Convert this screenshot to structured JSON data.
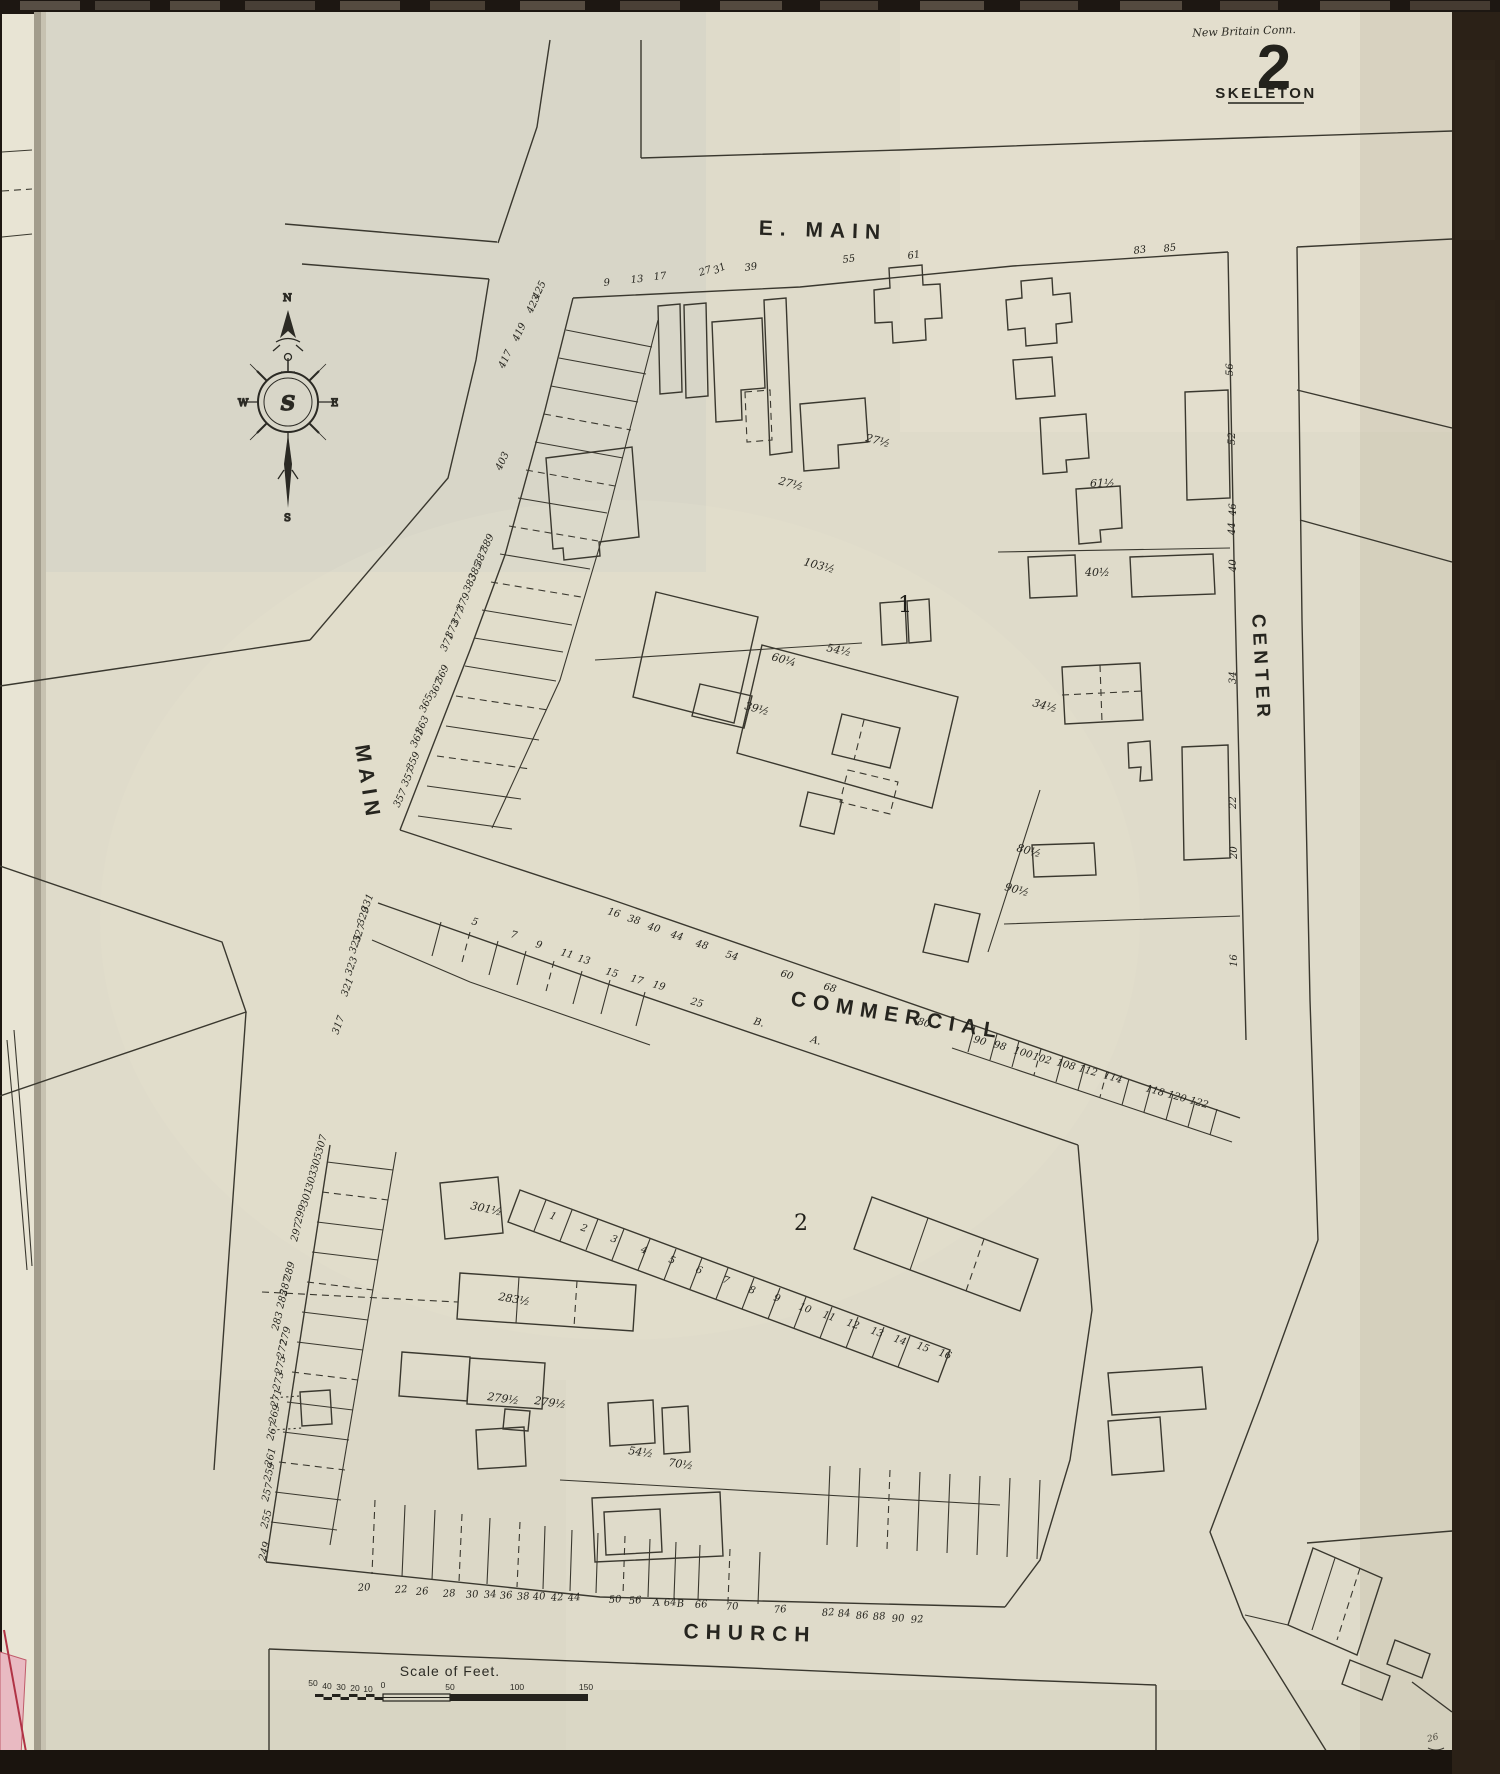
{
  "header": {
    "city_note": "New Britain Conn.",
    "sheet_number": "2",
    "map_type": "SKELETON"
  },
  "compass": {
    "north": "N",
    "south": "S",
    "east": "E",
    "west": "W",
    "monogram": "S"
  },
  "streets": {
    "e_main": "E. MAIN",
    "main": "MAIN",
    "center": "CENTER",
    "commercial": "COMMERCIAL",
    "church": "CHURCH"
  },
  "blocks": {
    "block1": "1",
    "block2": "2"
  },
  "scale_bar": {
    "title": "Scale of Feet.",
    "ticks": [
      {
        "t": "50",
        "x": 313,
        "y": 1686
      },
      {
        "t": "40",
        "x": 327,
        "y": 1689
      },
      {
        "t": "30",
        "x": 341,
        "y": 1690
      },
      {
        "t": "20",
        "x": 355,
        "y": 1691
      },
      {
        "t": "10",
        "x": 368,
        "y": 1692
      },
      {
        "t": "0",
        "x": 383,
        "y": 1688
      },
      {
        "t": "50",
        "x": 450,
        "y": 1690
      },
      {
        "t": "100",
        "x": 517,
        "y": 1690
      },
      {
        "t": "150",
        "x": 586,
        "y": 1690
      }
    ]
  },
  "page_ref": "26",
  "colors": {
    "paper": "#dfdbca",
    "ink": "#3a382f",
    "label_ink": "#26251f",
    "adjacent_sheet_pink": "#e9bac2",
    "binding_dark": "#1d1712"
  },
  "labels": [
    {
      "t": "9",
      "x": 604,
      "y": 286,
      "r": -6
    },
    {
      "t": "13",
      "x": 631,
      "y": 283,
      "r": -6
    },
    {
      "t": "17",
      "x": 654,
      "y": 280,
      "r": -6
    },
    {
      "t": "27",
      "x": 700,
      "y": 276,
      "r": -18
    },
    {
      "t": "31",
      "x": 715,
      "y": 274,
      "r": -25
    },
    {
      "t": "39",
      "x": 745,
      "y": 271,
      "r": -8
    },
    {
      "t": "55",
      "x": 843,
      "y": 263,
      "r": -8
    },
    {
      "t": "61",
      "x": 908,
      "y": 259,
      "r": -8
    },
    {
      "t": "83",
      "x": 1134,
      "y": 254,
      "r": -8
    },
    {
      "t": "85",
      "x": 1164,
      "y": 252,
      "r": -8
    },
    {
      "t": "56",
      "x": 1233,
      "y": 376,
      "r": -90
    },
    {
      "t": "52",
      "x": 1235,
      "y": 445,
      "r": -90
    },
    {
      "t": "46",
      "x": 1236,
      "y": 516,
      "r": -90
    },
    {
      "t": "44",
      "x": 1235,
      "y": 535,
      "r": -90
    },
    {
      "t": "40",
      "x": 1236,
      "y": 572,
      "r": -90
    },
    {
      "t": "34",
      "x": 1236,
      "y": 684,
      "r": -90
    },
    {
      "t": "22",
      "x": 1236,
      "y": 809,
      "r": -90
    },
    {
      "t": "20",
      "x": 1237,
      "y": 859,
      "r": -90
    },
    {
      "t": "16",
      "x": 1237,
      "y": 967,
      "r": -90
    },
    {
      "t": "425",
      "x": 538,
      "y": 300,
      "r": -65
    },
    {
      "t": "423",
      "x": 532,
      "y": 314,
      "r": -65
    },
    {
      "t": "419",
      "x": 518,
      "y": 342,
      "r": -65
    },
    {
      "t": "417",
      "x": 504,
      "y": 369,
      "r": -65
    },
    {
      "t": "403",
      "x": 501,
      "y": 471,
      "r": -65
    },
    {
      "t": "389",
      "x": 486,
      "y": 553,
      "r": -65
    },
    {
      "t": "387",
      "x": 480,
      "y": 567,
      "r": -65
    },
    {
      "t": "385",
      "x": 474,
      "y": 581,
      "r": -65
    },
    {
      "t": "383",
      "x": 469,
      "y": 593,
      "r": -65
    },
    {
      "t": "379",
      "x": 462,
      "y": 612,
      "r": -65
    },
    {
      "t": "377",
      "x": 457,
      "y": 626,
      "r": -65
    },
    {
      "t": "373",
      "x": 451,
      "y": 639,
      "r": -65
    },
    {
      "t": "371",
      "x": 446,
      "y": 652,
      "r": -65
    },
    {
      "t": "369",
      "x": 441,
      "y": 684,
      "r": -65
    },
    {
      "t": "367",
      "x": 435,
      "y": 698,
      "r": -65
    },
    {
      "t": "365",
      "x": 425,
      "y": 713,
      "r": -65
    },
    {
      "t": "363",
      "x": 421,
      "y": 735,
      "r": -65
    },
    {
      "t": "361",
      "x": 416,
      "y": 748,
      "r": -65
    },
    {
      "t": "359",
      "x": 412,
      "y": 771,
      "r": -65
    },
    {
      "t": "357",
      "x": 407,
      "y": 787,
      "r": -65
    },
    {
      "t": "357",
      "x": 399,
      "y": 808,
      "r": -65
    },
    {
      "t": "331",
      "x": 367,
      "y": 913,
      "r": -70
    },
    {
      "t": "329",
      "x": 363,
      "y": 926,
      "r": -70
    },
    {
      "t": "327",
      "x": 359,
      "y": 943,
      "r": -70
    },
    {
      "t": "325",
      "x": 355,
      "y": 954,
      "r": -70
    },
    {
      "t": "323",
      "x": 351,
      "y": 976,
      "r": -70
    },
    {
      "t": "321",
      "x": 347,
      "y": 997,
      "r": -70
    },
    {
      "t": "317",
      "x": 338,
      "y": 1035,
      "r": -70
    },
    {
      "t": "16",
      "x": 607,
      "y": 914,
      "r": 16
    },
    {
      "t": "38",
      "x": 627,
      "y": 921,
      "r": 16
    },
    {
      "t": "40",
      "x": 647,
      "y": 929,
      "r": 16
    },
    {
      "t": "44",
      "x": 670,
      "y": 937,
      "r": 16
    },
    {
      "t": "48",
      "x": 695,
      "y": 946,
      "r": 16
    },
    {
      "t": "54",
      "x": 725,
      "y": 957,
      "r": 16
    },
    {
      "t": "60",
      "x": 780,
      "y": 976,
      "r": 16
    },
    {
      "t": "68",
      "x": 823,
      "y": 989,
      "r": 16
    },
    {
      "t": "80",
      "x": 917,
      "y": 1024,
      "r": 16
    },
    {
      "t": "90",
      "x": 973,
      "y": 1042,
      "r": 16
    },
    {
      "t": "98",
      "x": 993,
      "y": 1047,
      "r": 16
    },
    {
      "t": "100",
      "x": 1013,
      "y": 1053,
      "r": 16
    },
    {
      "t": "102",
      "x": 1032,
      "y": 1059,
      "r": 16
    },
    {
      "t": "108",
      "x": 1056,
      "y": 1065,
      "r": 16
    },
    {
      "t": "112",
      "x": 1078,
      "y": 1071,
      "r": 16
    },
    {
      "t": "114",
      "x": 1103,
      "y": 1078,
      "r": 16
    },
    {
      "t": "118",
      "x": 1145,
      "y": 1091,
      "r": 16
    },
    {
      "t": "120",
      "x": 1167,
      "y": 1097,
      "r": 16
    },
    {
      "t": "122",
      "x": 1189,
      "y": 1103,
      "r": 16
    },
    {
      "t": "5",
      "x": 471,
      "y": 924,
      "r": 16
    },
    {
      "t": "7",
      "x": 510,
      "y": 937,
      "r": 16
    },
    {
      "t": "9",
      "x": 535,
      "y": 947,
      "r": 16
    },
    {
      "t": "11",
      "x": 560,
      "y": 955,
      "r": 16
    },
    {
      "t": "13",
      "x": 577,
      "y": 961,
      "r": 16
    },
    {
      "t": "15",
      "x": 605,
      "y": 974,
      "r": 16
    },
    {
      "t": "17",
      "x": 630,
      "y": 981,
      "r": 16
    },
    {
      "t": "19",
      "x": 652,
      "y": 987,
      "r": 16
    },
    {
      "t": "25",
      "x": 690,
      "y": 1004,
      "r": 16
    },
    {
      "t": "B.",
      "x": 753,
      "y": 1024,
      "r": 16
    },
    {
      "t": "A.",
      "x": 810,
      "y": 1042,
      "r": 16
    },
    {
      "t": "307",
      "x": 322,
      "y": 1154,
      "r": -75
    },
    {
      "t": "305",
      "x": 317,
      "y": 1172,
      "r": -75
    },
    {
      "t": "303",
      "x": 312,
      "y": 1190,
      "r": -75
    },
    {
      "t": "301",
      "x": 307,
      "y": 1207,
      "r": -75
    },
    {
      "t": "299",
      "x": 301,
      "y": 1224,
      "r": -75
    },
    {
      "t": "297",
      "x": 297,
      "y": 1242,
      "r": -75
    },
    {
      "t": "289",
      "x": 290,
      "y": 1281,
      "r": -75
    },
    {
      "t": "287",
      "x": 286,
      "y": 1296,
      "r": -75
    },
    {
      "t": "285",
      "x": 283,
      "y": 1309,
      "r": -75
    },
    {
      "t": "283",
      "x": 278,
      "y": 1331,
      "r": -75
    },
    {
      "t": "279",
      "x": 286,
      "y": 1346,
      "r": -75
    },
    {
      "t": "277",
      "x": 283,
      "y": 1359,
      "r": -75
    },
    {
      "t": "275",
      "x": 281,
      "y": 1375,
      "r": -75
    },
    {
      "t": "273",
      "x": 279,
      "y": 1391,
      "r": -75
    },
    {
      "t": "271",
      "x": 277,
      "y": 1408,
      "r": -75
    },
    {
      "t": "269",
      "x": 275,
      "y": 1424,
      "r": -75
    },
    {
      "t": "267",
      "x": 273,
      "y": 1441,
      "r": -75
    },
    {
      "t": "261",
      "x": 271,
      "y": 1467,
      "r": -75
    },
    {
      "t": "259",
      "x": 270,
      "y": 1482,
      "r": -75
    },
    {
      "t": "257",
      "x": 268,
      "y": 1502,
      "r": -75
    },
    {
      "t": "255",
      "x": 267,
      "y": 1529,
      "r": -75
    },
    {
      "t": "249",
      "x": 265,
      "y": 1561,
      "r": -75
    },
    {
      "t": "20",
      "x": 358,
      "y": 1591,
      "r": -4
    },
    {
      "t": "22",
      "x": 395,
      "y": 1593,
      "r": -4
    },
    {
      "t": "26",
      "x": 416,
      "y": 1595,
      "r": -4
    },
    {
      "t": "28",
      "x": 443,
      "y": 1597,
      "r": -4
    },
    {
      "t": "30",
      "x": 466,
      "y": 1598,
      "r": -4
    },
    {
      "t": "34",
      "x": 484,
      "y": 1598,
      "r": -4
    },
    {
      "t": "36",
      "x": 500,
      "y": 1599,
      "r": -4
    },
    {
      "t": "38",
      "x": 517,
      "y": 1600,
      "r": -4
    },
    {
      "t": "40",
      "x": 533,
      "y": 1600,
      "r": -4
    },
    {
      "t": "42",
      "x": 551,
      "y": 1601,
      "r": -4
    },
    {
      "t": "44",
      "x": 568,
      "y": 1601,
      "r": -4
    },
    {
      "t": "50",
      "x": 609,
      "y": 1603,
      "r": -4
    },
    {
      "t": "56",
      "x": 629,
      "y": 1604,
      "r": -4
    },
    {
      "t": "A",
      "x": 653,
      "y": 1606,
      "r": -4
    },
    {
      "t": "64",
      "x": 664,
      "y": 1606,
      "r": -4
    },
    {
      "t": "B",
      "x": 677,
      "y": 1607,
      "r": -4
    },
    {
      "t": "66",
      "x": 695,
      "y": 1608,
      "r": -4
    },
    {
      "t": "70",
      "x": 726,
      "y": 1610,
      "r": -4
    },
    {
      "t": "76",
      "x": 774,
      "y": 1613,
      "r": -4
    },
    {
      "t": "82",
      "x": 822,
      "y": 1616,
      "r": -4
    },
    {
      "t": "84",
      "x": 838,
      "y": 1617,
      "r": -4
    },
    {
      "t": "86",
      "x": 856,
      "y": 1619,
      "r": -4
    },
    {
      "t": "88",
      "x": 873,
      "y": 1620,
      "r": -4
    },
    {
      "t": "90",
      "x": 892,
      "y": 1622,
      "r": -4
    },
    {
      "t": "92",
      "x": 911,
      "y": 1623,
      "r": -4
    },
    {
      "t": "1",
      "x": 549,
      "y": 1218,
      "r": 20
    },
    {
      "t": "2",
      "x": 580,
      "y": 1230,
      "r": 20
    },
    {
      "t": "3",
      "x": 610,
      "y": 1241,
      "r": 20
    },
    {
      "t": "4",
      "x": 640,
      "y": 1252,
      "r": 20
    },
    {
      "t": "5",
      "x": 668,
      "y": 1262,
      "r": 20
    },
    {
      "t": "6",
      "x": 695,
      "y": 1272,
      "r": 20
    },
    {
      "t": "7",
      "x": 722,
      "y": 1282,
      "r": 20
    },
    {
      "t": "8",
      "x": 748,
      "y": 1292,
      "r": 20
    },
    {
      "t": "9",
      "x": 773,
      "y": 1300,
      "r": 20
    },
    {
      "t": "10",
      "x": 798,
      "y": 1309,
      "r": 20
    },
    {
      "t": "11",
      "x": 822,
      "y": 1317,
      "r": 20
    },
    {
      "t": "12",
      "x": 846,
      "y": 1325,
      "r": 20
    },
    {
      "t": "13",
      "x": 870,
      "y": 1333,
      "r": 20
    },
    {
      "t": "14",
      "x": 893,
      "y": 1341,
      "r": 20
    },
    {
      "t": "15",
      "x": 916,
      "y": 1348,
      "r": 20
    },
    {
      "t": "16",
      "x": 938,
      "y": 1355,
      "r": 20
    },
    {
      "t": "27½",
      "x": 865,
      "y": 441,
      "r": 15,
      "c": "b"
    },
    {
      "t": "27½",
      "x": 778,
      "y": 484,
      "r": 15,
      "c": "b"
    },
    {
      "t": "103½",
      "x": 803,
      "y": 565,
      "r": 15,
      "c": "b"
    },
    {
      "t": "54½",
      "x": 826,
      "y": 651,
      "r": 12,
      "c": "b"
    },
    {
      "t": "60¼",
      "x": 771,
      "y": 660,
      "r": 15,
      "c": "b"
    },
    {
      "t": "39½",
      "x": 744,
      "y": 709,
      "r": 15,
      "c": "b"
    },
    {
      "t": "34½",
      "x": 1032,
      "y": 706,
      "r": 15,
      "c": "b"
    },
    {
      "t": "61½",
      "x": 1090,
      "y": 487,
      "r": 0,
      "c": "b"
    },
    {
      "t": "40½",
      "x": 1085,
      "y": 576,
      "r": 0,
      "c": "b"
    },
    {
      "t": "80½",
      "x": 1016,
      "y": 851,
      "r": 15,
      "c": "b"
    },
    {
      "t": "90½",
      "x": 1004,
      "y": 890,
      "r": 15,
      "c": "b"
    },
    {
      "t": "301½",
      "x": 470,
      "y": 1209,
      "r": 12,
      "c": "b"
    },
    {
      "t": "283½",
      "x": 498,
      "y": 1300,
      "r": 10,
      "c": "b"
    },
    {
      "t": "279½",
      "x": 487,
      "y": 1400,
      "r": 8,
      "c": "b"
    },
    {
      "t": "279½",
      "x": 534,
      "y": 1404,
      "r": 8,
      "c": "b"
    },
    {
      "t": "54½",
      "x": 628,
      "y": 1454,
      "r": 8,
      "c": "b"
    },
    {
      "t": "70½",
      "x": 668,
      "y": 1466,
      "r": 8,
      "c": "b"
    },
    {
      "t": "26",
      "x": 1428,
      "y": 1742,
      "r": -15,
      "c": "pg"
    }
  ]
}
